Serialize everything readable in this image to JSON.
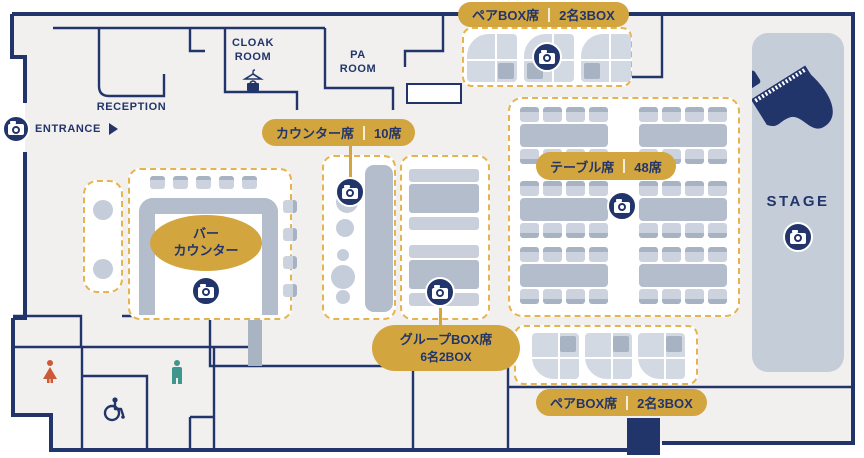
{
  "palette": {
    "navy": "#22356b",
    "gold": "#d2a53e",
    "gold_dash": "#e6b44f",
    "floor": "#f1f0ee",
    "seat_light": "#ccd3de",
    "seat_dark": "#a7b2c2",
    "table_gray": "#b4bdcb",
    "stage_bg": "#c5cdd9",
    "female": "#cb5a38",
    "male": "#3f968c"
  },
  "rooms": {
    "reception": "RECEPTION",
    "cloak_line1": "CLOAK",
    "cloak_line2": "ROOM",
    "pa_line1": "PA",
    "pa_line2": "ROOM",
    "entrance": "ENTRANCE",
    "stage": "STAGE"
  },
  "areas": {
    "pair_box_top": {
      "label": "ペアBOX席",
      "capacity": "2名3BOX"
    },
    "counter": {
      "label": "カウンター席",
      "capacity": "10席"
    },
    "table": {
      "label": "テーブル席",
      "capacity": "48席"
    },
    "bar": {
      "line1": "バー",
      "line2": "カウンター"
    },
    "group_box": {
      "label": "グループBOX席",
      "capacity": "6名2BOX"
    },
    "pair_box_bottom": {
      "label": "ペアBOX席",
      "capacity": "2名3BOX"
    }
  },
  "icons": {
    "camera": "photo-spot-camera",
    "hanger": "cloak-hanger",
    "bag": "cloak-bag",
    "piano": "grand-piano",
    "female": "women-toilet",
    "male": "men-toilet",
    "wheelchair": "accessible-toilet",
    "arrow": "entrance-direction"
  }
}
